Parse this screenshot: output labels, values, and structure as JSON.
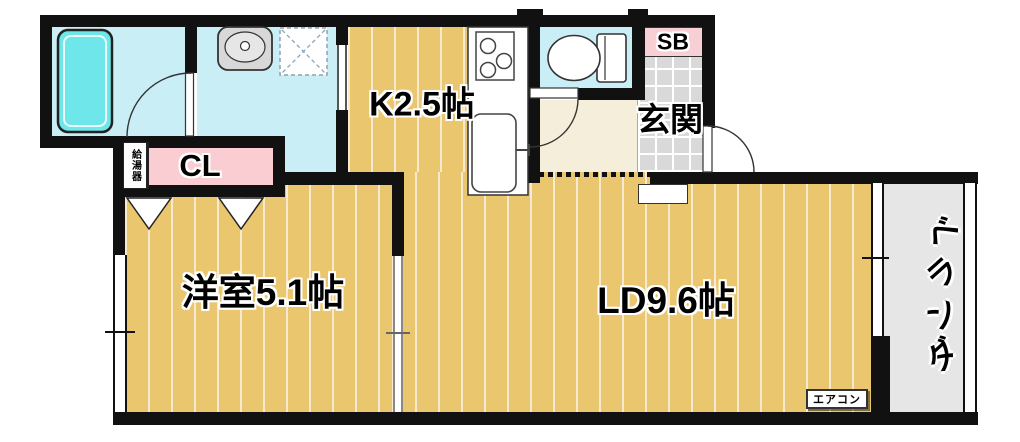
{
  "plan": {
    "type": "apartment-floorplan",
    "labels": {
      "kitchen": "K2.5帖",
      "living_dining": "LD9.6帖",
      "western_room": "洋室5.1帖",
      "entrance": "玄関",
      "closet": "CL",
      "shoe_box": "SB",
      "water_heater": "給湯器",
      "aircon": "エアコン",
      "veranda": "ベランダ",
      "veranda_chars": [
        "ベ",
        "ラ",
        "ン",
        "ダ"
      ]
    },
    "colors": {
      "wall": "#111111",
      "floor_wood": "#eac76e",
      "floor_stripe": "#f7ead0",
      "wet_area": "#c9eef5",
      "bathtub": "#6fe7ea",
      "closet_pink": "#f9cdd2",
      "shoe_box_pink": "#f8cfd4",
      "hall_cream": "#f4eeda",
      "tile_gray": "#d9d9d9",
      "veranda_gray": "#e6e6e6"
    }
  }
}
